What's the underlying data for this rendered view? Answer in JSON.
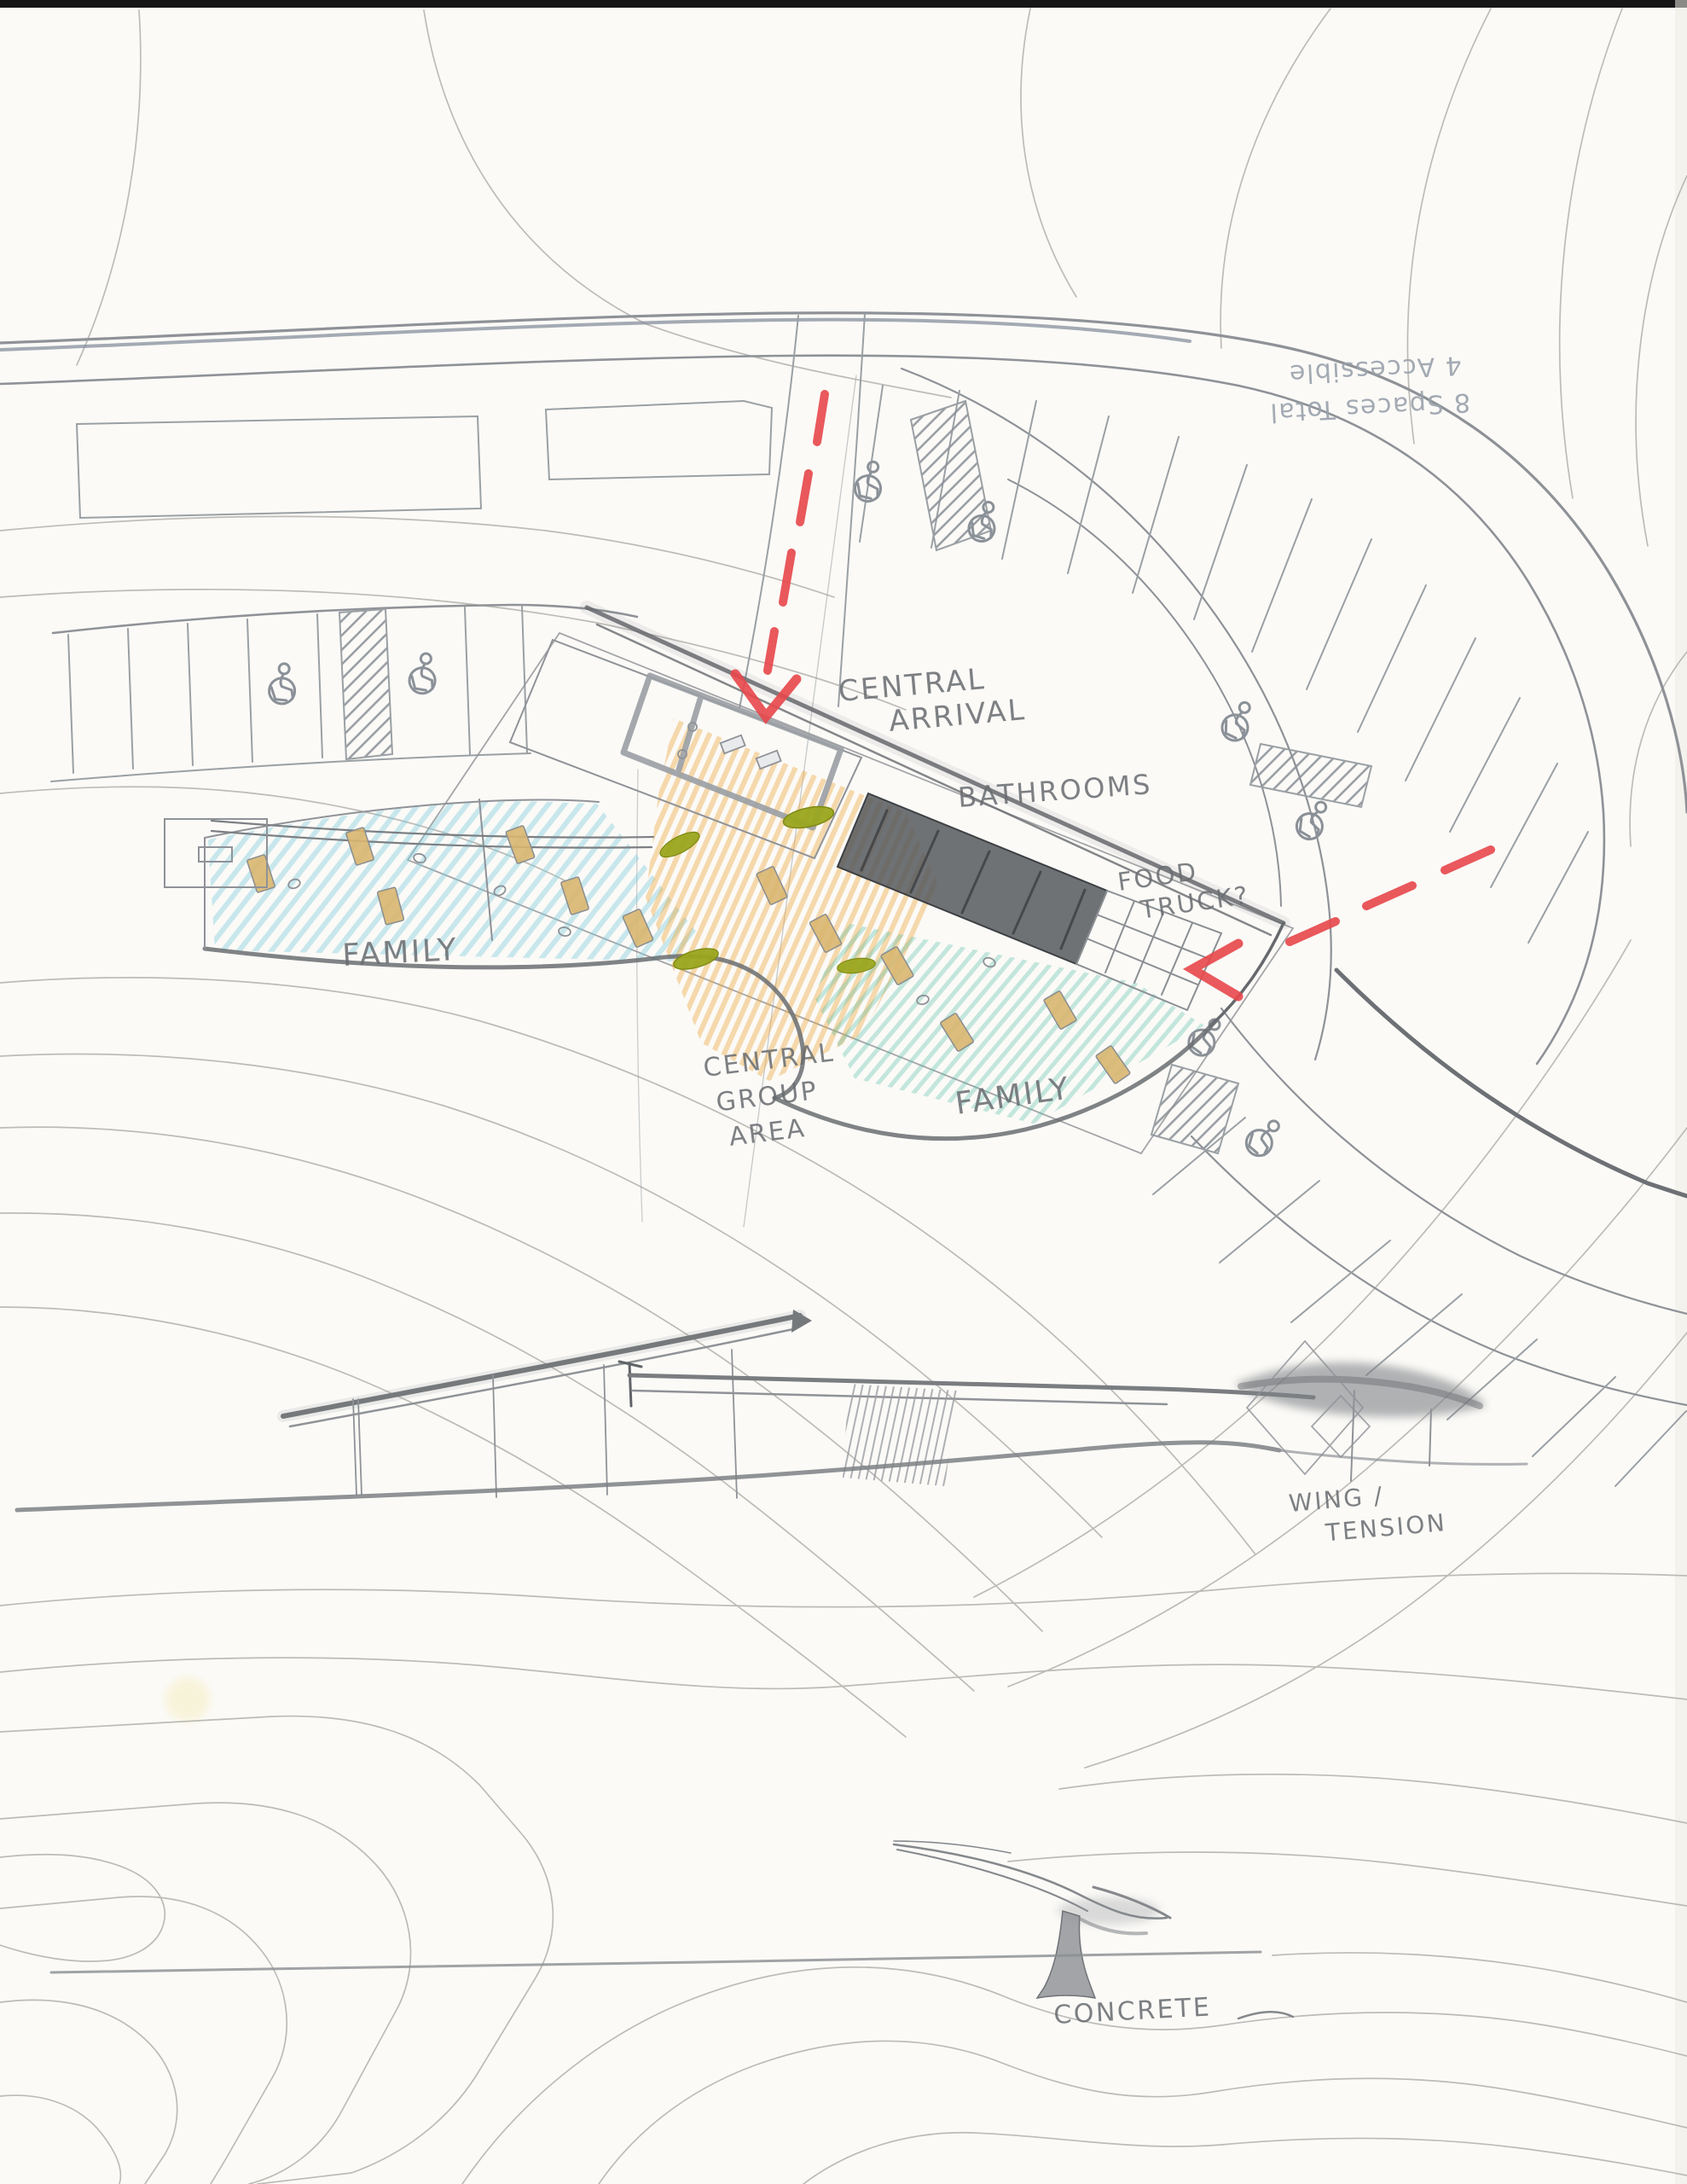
{
  "labels": {
    "central_arrival": [
      "CENTRAL",
      "ARRIVAL"
    ],
    "bathrooms": [
      "BATHROOMS"
    ],
    "food_truck": [
      "FOOD",
      "TRUCK?"
    ],
    "family_left": [
      "FAMILY"
    ],
    "central_group_area": [
      "CENTRAL",
      "GROUP",
      "AREA"
    ],
    "family_right": [
      "FAMILY"
    ],
    "wing_tension": [
      "WING /",
      "TENSION"
    ],
    "concrete": [
      "CONCRETE"
    ],
    "parking_note": [
      "8 Spaces Total",
      "4 Accessible"
    ]
  },
  "colors": {
    "paper": "#fbfaf7",
    "contour": "#b7b5b0",
    "pencil": "#8f9297",
    "pencil_dark": "#66696d",
    "route_red": "#e8474b",
    "plaza_orange": "#eda73e",
    "terrace_blue": "#7ccbdc",
    "terrace_teal": "#54bfa8",
    "bush_olive": "#9aa51e",
    "table_tan": "#d9b66f",
    "bathroom_gray": "#56595d",
    "note_gray": "#9aa2ac"
  },
  "icons": {
    "accessible_parking": "wheelchair-isa-icon",
    "no_parking": "diagonal-hatch-zone",
    "route": "red-dashed-arrow"
  }
}
